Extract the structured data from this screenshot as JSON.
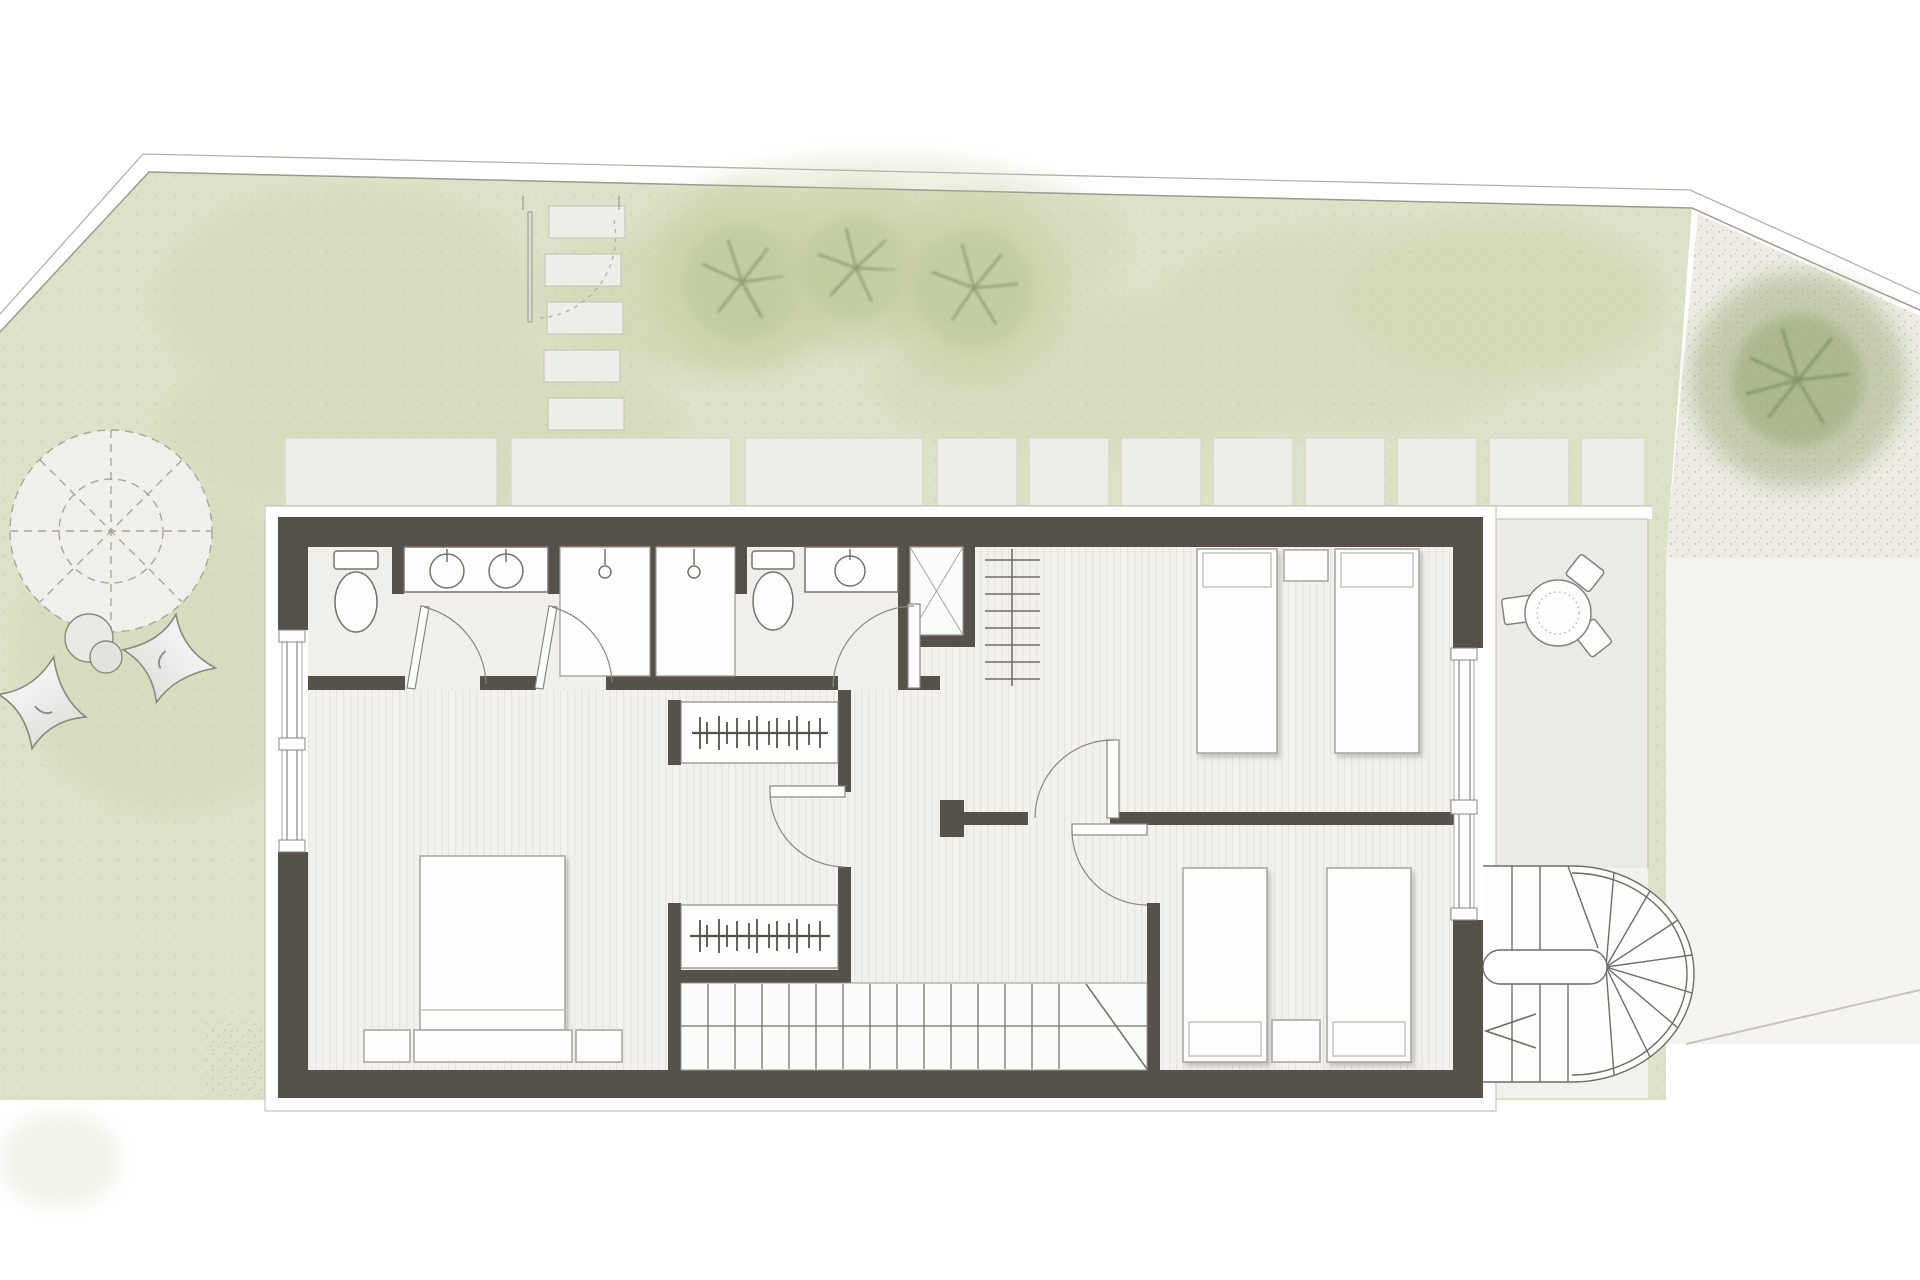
{
  "scene": {
    "aria_label": "Watercolor architectural floor plan: upper floor of a house with garden, lawn, terrace, round table, interior straight stair and exterior fan staircase",
    "style": "top-down watercolor site plan",
    "has_text": false
  },
  "palette": {
    "background": "#ffffff",
    "lawn": "#dce1c7",
    "lawn_speckle": "#b8c094",
    "tree_soft": "#c6d0a6",
    "tree_dark": "#a9b88c",
    "branch": "#82926a",
    "gravel": "#edebe3",
    "driveway": "#f4f3ef",
    "paver": "#eeece6",
    "terrace": "#eceae4",
    "wall": "#57514b",
    "wood_floor": "#f2f1ec",
    "wood_stripe": "#e6e5df",
    "bath_floor": "#f0efe9",
    "fixture_fill": "#fdfdfc",
    "fixture_line": "#75736c",
    "outline": "#9b9a90"
  },
  "site": {
    "features": [
      {
        "name": "lawn",
        "shape": "irregular polygon"
      },
      {
        "name": "plot-boundary",
        "style": "double thin line"
      },
      {
        "name": "stepping-stones",
        "count": 5
      },
      {
        "name": "garden-gate",
        "state": "open",
        "swing": "dashed arc"
      },
      {
        "name": "garden-trees-soft",
        "count": 3
      },
      {
        "name": "large-tree-east",
        "count": 1
      },
      {
        "name": "tree-symbol-dashed-circle",
        "style": "dashed circle, inner circle, 8 spokes",
        "count": 1
      },
      {
        "name": "boulders",
        "count": 2
      },
      {
        "name": "butterfly-chairs",
        "count": 2
      },
      {
        "name": "patio-pavers",
        "count": 11
      },
      {
        "name": "gravel-area",
        "position": "north-east"
      },
      {
        "name": "driveway",
        "position": "east"
      }
    ]
  },
  "terrace": {
    "round_table": 1,
    "dotted_placemat_circle": 1,
    "chairs": 3,
    "position": "east of building"
  },
  "building": {
    "walls": "thick dark warm-grey",
    "windows": [
      {
        "side": "west",
        "sill_blocks": 3
      },
      {
        "side": "east",
        "sill_blocks": 3
      }
    ],
    "rooms": [
      {
        "name": "bathroom-west",
        "fixtures": [
          "toilet",
          "vanity with 2 round basins",
          "shower stall with drain",
          "shower stall with drain"
        ]
      },
      {
        "name": "bathroom-center",
        "fixtures": [
          "toilet",
          "vanity with round basin",
          "duct-shaft-x",
          "towel-radiator 8 bars"
        ]
      },
      {
        "name": "master-bedroom",
        "position": "south-west",
        "fixtures": [
          "double bed",
          "headboard",
          "nightstand",
          "nightstand"
        ]
      },
      {
        "name": "hallway",
        "fixtures": [
          "wardrobe with hanger rail",
          "wardrobe with hanger rail"
        ]
      },
      {
        "name": "bedroom-northeast",
        "fixtures": [
          "single bed with pillow",
          "single bed with pillow",
          "nightstand"
        ]
      },
      {
        "name": "bedroom-southeast",
        "fixtures": [
          "single bed with pillow",
          "single bed with pillow",
          "nightstand"
        ]
      }
    ],
    "doors": {
      "interior_swing": 4,
      "shower_glass": 2,
      "garden_gate": 1
    },
    "stairs": [
      {
        "name": "main-stair",
        "type": "straight",
        "location": "south interior",
        "treads": 14,
        "break_line": true
      },
      {
        "name": "spiral-stair",
        "type": "half-turn fan stair",
        "location": "east exterior",
        "direction_arrow": "left"
      }
    ]
  }
}
